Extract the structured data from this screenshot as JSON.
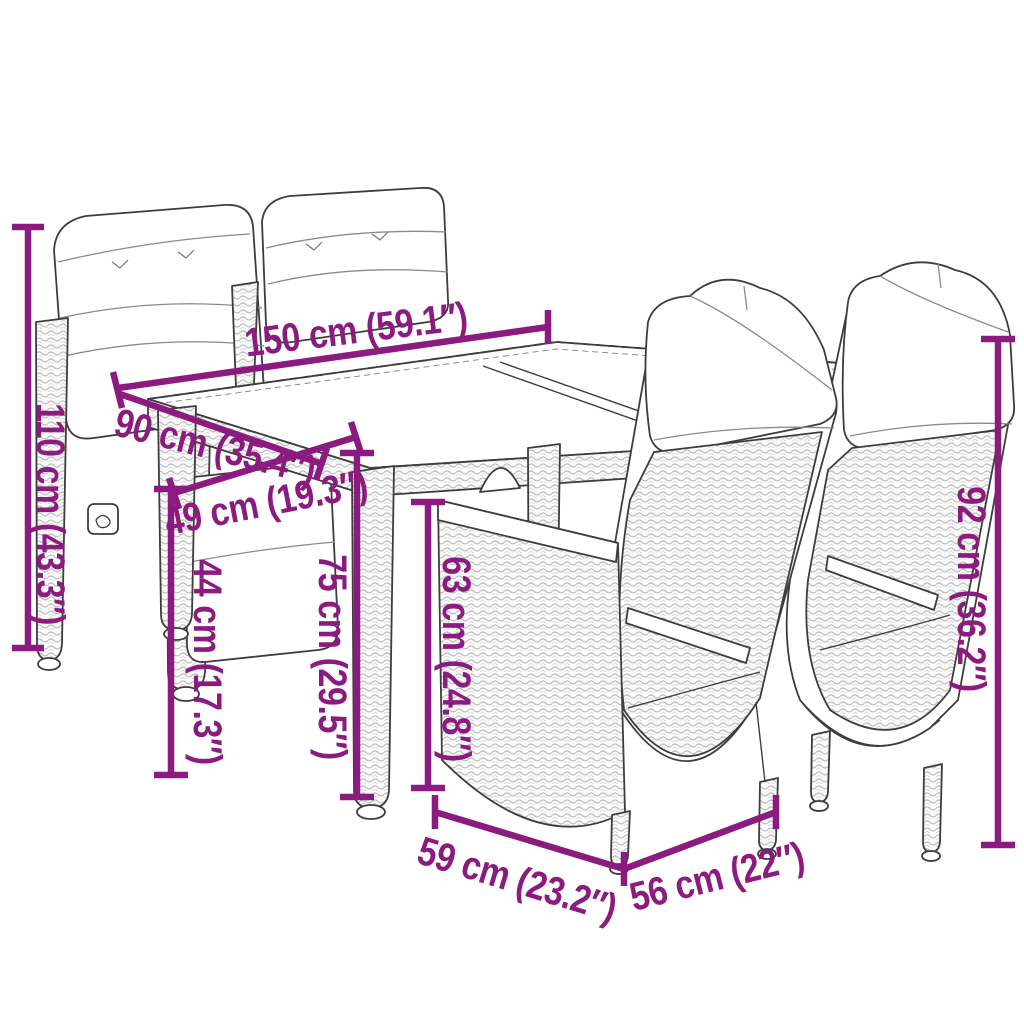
{
  "scene": {
    "description": "Line-art product dimension diagram of a rattan garden dining set: glass-top table with cushioned reclining chairs",
    "pieces": "5"
  },
  "colors": {
    "dimension_accent": "#8C1B80",
    "line_art": "#3d3d3d",
    "background": "#ffffff"
  },
  "dims": {
    "d150": {
      "cm": "150",
      "inch": "59.1",
      "label": "150 cm (59.1″)"
    },
    "d90": {
      "cm": "90",
      "inch": "35.4",
      "label": "90 cm (35.4″)"
    },
    "d110": {
      "cm": "110",
      "inch": "43.3",
      "label": "110 cm (43.3″)"
    },
    "d49": {
      "cm": "49",
      "inch": "19.3",
      "label": "49 cm (19.3″)"
    },
    "d44": {
      "cm": "44",
      "inch": "17.3",
      "label": "44 cm (17.3″)"
    },
    "d75": {
      "cm": "75",
      "inch": "29.5",
      "label": "75 cm (29.5″)"
    },
    "d63": {
      "cm": "63",
      "inch": "24.8",
      "label": "63 cm (24.8″)"
    },
    "d92": {
      "cm": "92",
      "inch": "36.2",
      "label": "92 cm (36.2″)"
    },
    "d59": {
      "cm": "59",
      "inch": "23.2",
      "label": "59 cm (23.2″)"
    },
    "d56": {
      "cm": "56",
      "inch": "22",
      "label": "56 cm (22″)"
    }
  }
}
